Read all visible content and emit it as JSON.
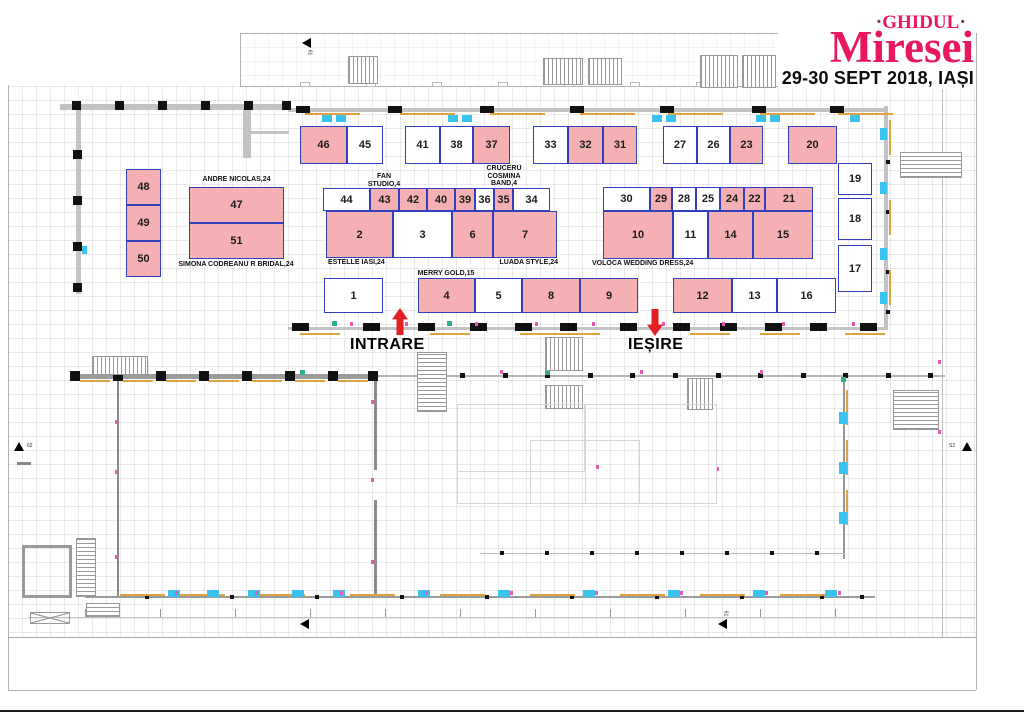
{
  "header": {
    "dot_left": "·",
    "brand_top": "GHIDUL",
    "dot_right": "·",
    "brand_main": "Miresei",
    "event_date": "29-30 SEPT 2018, IAȘI"
  },
  "signage": {
    "entrance": "INTRARE",
    "exit": "IEȘIRE"
  },
  "axis_markers": {
    "left": "62",
    "right": "S2",
    "top": "61",
    "bottom_left": "61",
    "bottom_right": "61"
  },
  "colors": {
    "brand_pink": "#e8175e",
    "booth_border_blue": "#3240c0",
    "booth_occupied_pink": "#f5b0b3",
    "arrow_red": "#e42025",
    "marker_cyan": "#3bc3ef",
    "sill_orange": "#e0a23e",
    "dot_magenta": "#e55bb0"
  },
  "booths": [
    {
      "n": "46",
      "x": 300,
      "y": 126,
      "w": 47,
      "h": 38,
      "occ": 1
    },
    {
      "n": "45",
      "x": 347,
      "y": 126,
      "w": 36,
      "h": 38,
      "occ": 0
    },
    {
      "n": "41",
      "x": 405,
      "y": 126,
      "w": 35,
      "h": 38,
      "occ": 0
    },
    {
      "n": "38",
      "x": 440,
      "y": 126,
      "w": 33,
      "h": 38,
      "occ": 0
    },
    {
      "n": "37",
      "x": 473,
      "y": 126,
      "w": 37,
      "h": 38,
      "occ": 1
    },
    {
      "n": "33",
      "x": 533,
      "y": 126,
      "w": 35,
      "h": 38,
      "occ": 0
    },
    {
      "n": "32",
      "x": 568,
      "y": 126,
      "w": 35,
      "h": 38,
      "occ": 1
    },
    {
      "n": "31",
      "x": 603,
      "y": 126,
      "w": 34,
      "h": 38,
      "occ": 1
    },
    {
      "n": "27",
      "x": 663,
      "y": 126,
      "w": 34,
      "h": 38,
      "occ": 0
    },
    {
      "n": "26",
      "x": 697,
      "y": 126,
      "w": 33,
      "h": 38,
      "occ": 0
    },
    {
      "n": "23",
      "x": 730,
      "y": 126,
      "w": 33,
      "h": 38,
      "occ": 1
    },
    {
      "n": "20",
      "x": 788,
      "y": 126,
      "w": 49,
      "h": 38,
      "occ": 1
    },
    {
      "n": "48",
      "x": 126,
      "y": 169,
      "w": 35,
      "h": 36,
      "occ": 1
    },
    {
      "n": "49",
      "x": 126,
      "y": 205,
      "w": 35,
      "h": 36,
      "occ": 1
    },
    {
      "n": "50",
      "x": 126,
      "y": 241,
      "w": 35,
      "h": 36,
      "occ": 1
    },
    {
      "n": "47",
      "x": 189,
      "y": 187,
      "w": 95,
      "h": 36,
      "occ": 1
    },
    {
      "n": "51",
      "x": 189,
      "y": 223,
      "w": 95,
      "h": 36,
      "occ": 1
    },
    {
      "n": "44",
      "x": 323,
      "y": 188,
      "w": 47,
      "h": 23,
      "occ": 0
    },
    {
      "n": "43",
      "x": 370,
      "y": 188,
      "w": 29,
      "h": 23,
      "occ": 1
    },
    {
      "n": "42",
      "x": 399,
      "y": 188,
      "w": 28,
      "h": 23,
      "occ": 1
    },
    {
      "n": "40",
      "x": 427,
      "y": 188,
      "w": 28,
      "h": 23,
      "occ": 1
    },
    {
      "n": "39",
      "x": 455,
      "y": 188,
      "w": 20,
      "h": 23,
      "occ": 1
    },
    {
      "n": "36",
      "x": 475,
      "y": 188,
      "w": 19,
      "h": 23,
      "occ": 0
    },
    {
      "n": "35",
      "x": 494,
      "y": 188,
      "w": 19,
      "h": 23,
      "occ": 1
    },
    {
      "n": "34",
      "x": 513,
      "y": 188,
      "w": 37,
      "h": 23,
      "occ": 0
    },
    {
      "n": "30",
      "x": 603,
      "y": 187,
      "w": 47,
      "h": 24,
      "occ": 0
    },
    {
      "n": "29",
      "x": 650,
      "y": 187,
      "w": 22,
      "h": 24,
      "occ": 1
    },
    {
      "n": "28",
      "x": 672,
      "y": 187,
      "w": 24,
      "h": 24,
      "occ": 0
    },
    {
      "n": "25",
      "x": 696,
      "y": 187,
      "w": 24,
      "h": 24,
      "occ": 0
    },
    {
      "n": "24",
      "x": 720,
      "y": 187,
      "w": 24,
      "h": 24,
      "occ": 1
    },
    {
      "n": "22",
      "x": 744,
      "y": 187,
      "w": 21,
      "h": 24,
      "occ": 1
    },
    {
      "n": "21",
      "x": 765,
      "y": 187,
      "w": 48,
      "h": 24,
      "occ": 1
    },
    {
      "n": "2",
      "x": 326,
      "y": 211,
      "w": 67,
      "h": 47,
      "occ": 1
    },
    {
      "n": "3",
      "x": 393,
      "y": 211,
      "w": 59,
      "h": 47,
      "occ": 0
    },
    {
      "n": "6",
      "x": 452,
      "y": 211,
      "w": 41,
      "h": 47,
      "occ": 1
    },
    {
      "n": "7",
      "x": 493,
      "y": 211,
      "w": 64,
      "h": 47,
      "occ": 1
    },
    {
      "n": "10",
      "x": 603,
      "y": 211,
      "w": 70,
      "h": 48,
      "occ": 1
    },
    {
      "n": "11",
      "x": 673,
      "y": 211,
      "w": 35,
      "h": 48,
      "occ": 0
    },
    {
      "n": "14",
      "x": 708,
      "y": 211,
      "w": 45,
      "h": 48,
      "occ": 1
    },
    {
      "n": "15",
      "x": 753,
      "y": 211,
      "w": 60,
      "h": 48,
      "occ": 1
    },
    {
      "n": "19",
      "x": 838,
      "y": 163,
      "w": 34,
      "h": 32,
      "occ": 0
    },
    {
      "n": "18",
      "x": 838,
      "y": 198,
      "w": 34,
      "h": 42,
      "occ": 0
    },
    {
      "n": "17",
      "x": 838,
      "y": 245,
      "w": 34,
      "h": 47,
      "occ": 0
    },
    {
      "n": "1",
      "x": 324,
      "y": 278,
      "w": 59,
      "h": 35,
      "occ": 0
    },
    {
      "n": "4",
      "x": 418,
      "y": 278,
      "w": 57,
      "h": 35,
      "occ": 1
    },
    {
      "n": "5",
      "x": 475,
      "y": 278,
      "w": 47,
      "h": 35,
      "occ": 0
    },
    {
      "n": "8",
      "x": 522,
      "y": 278,
      "w": 58,
      "h": 35,
      "occ": 1
    },
    {
      "n": "9",
      "x": 580,
      "y": 278,
      "w": 58,
      "h": 35,
      "occ": 1
    },
    {
      "n": "12",
      "x": 673,
      "y": 278,
      "w": 59,
      "h": 35,
      "occ": 1
    },
    {
      "n": "13",
      "x": 732,
      "y": 278,
      "w": 45,
      "h": 35,
      "occ": 0
    },
    {
      "n": "16",
      "x": 777,
      "y": 278,
      "w": 59,
      "h": 35,
      "occ": 0
    }
  ],
  "vendor_labels": [
    {
      "name": "andre-nicolas",
      "text": "ANDRE NICOLAS,24",
      "x": 189,
      "y": 176,
      "w": 95,
      "align": "center"
    },
    {
      "name": "simona-codreanu",
      "text": "SIMONA CODREANU R BRIDAL,24",
      "x": 172,
      "y": 261,
      "w": 128,
      "align": "center"
    },
    {
      "name": "fan-studio",
      "text": "FAN\nSTUDIO,4",
      "x": 362,
      "y": 173,
      "w": 44,
      "align": "center"
    },
    {
      "name": "cruceru-cosmina-band",
      "text": "CRUCERU\nCOSMINA\nBAND,4",
      "x": 481,
      "y": 165,
      "w": 46,
      "align": "center"
    },
    {
      "name": "estelle-iasi",
      "text": "ESTELLE IASI,24",
      "x": 328,
      "y": 259,
      "w": 78,
      "align": "left"
    },
    {
      "name": "luada-style",
      "text": "LUADA STYLE,24",
      "x": 492,
      "y": 259,
      "w": 66,
      "align": "right"
    },
    {
      "name": "voloca-wedding-dress",
      "text": "VOLOCA WEDDING DRESS,24",
      "x": 592,
      "y": 260,
      "w": 105,
      "align": "left"
    },
    {
      "name": "merry-gold",
      "text": "MERRY GOLD,15",
      "x": 416,
      "y": 270,
      "w": 60,
      "align": "center"
    }
  ]
}
